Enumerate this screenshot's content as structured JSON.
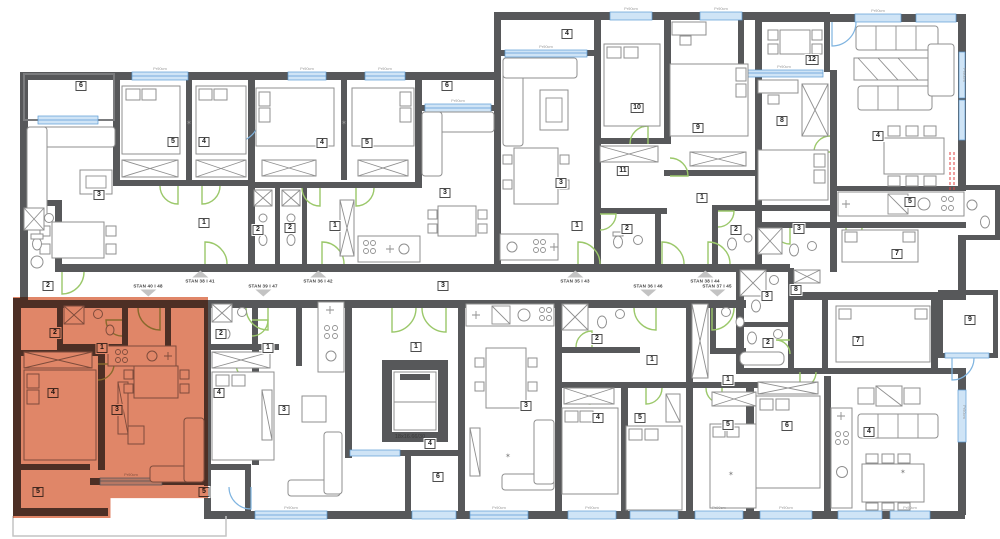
{
  "floorplan": {
    "stairs_note": "18x16.66/30",
    "window_label": "Pr90cm",
    "colors": {
      "wall": "#57585a",
      "door": "#9bc86a",
      "window_fill": "#cfe4f6",
      "window_line": "#5b9bd5",
      "furniture": "#8f8f8f",
      "arrow": "#c3c3c3",
      "red_dash": "#e04040",
      "highlight": "#e08668"
    },
    "highlight": {
      "left": 13,
      "top": 297,
      "width": 195,
      "height": 221
    },
    "corridor_labels": [
      {
        "text": "STAN 38 I 41",
        "x": 200,
        "y": 277,
        "dir": "up"
      },
      {
        "text": "STAN 36 I 42",
        "x": 318,
        "y": 277,
        "dir": "up"
      },
      {
        "text": "STAN 35 I 43",
        "x": 575,
        "y": 277,
        "dir": "up"
      },
      {
        "text": "STAN 38 I 44",
        "x": 705,
        "y": 277,
        "dir": "up"
      },
      {
        "text": "STAN 40 I 48",
        "x": 148,
        "y": 290,
        "dir": "down"
      },
      {
        "text": "STAN 39 I 47",
        "x": 263,
        "y": 290,
        "dir": "down"
      },
      {
        "text": "STAN 36 I 46",
        "x": 648,
        "y": 290,
        "dir": "down"
      },
      {
        "text": "STAN 37 I 45",
        "x": 717,
        "y": 290,
        "dir": "down"
      }
    ],
    "room_badges": [
      {
        "n": "6",
        "x": 81,
        "y": 86
      },
      {
        "n": "5",
        "x": 173,
        "y": 142
      },
      {
        "n": "4",
        "x": 204,
        "y": 142
      },
      {
        "n": "3",
        "x": 99,
        "y": 195
      },
      {
        "n": "1",
        "x": 204,
        "y": 223
      },
      {
        "n": "2",
        "x": 48,
        "y": 286
      },
      {
        "n": "4",
        "x": 322,
        "y": 143
      },
      {
        "n": "5",
        "x": 367,
        "y": 143
      },
      {
        "n": "6",
        "x": 447,
        "y": 86
      },
      {
        "n": "3",
        "x": 445,
        "y": 193
      },
      {
        "n": "1",
        "x": 335,
        "y": 226
      },
      {
        "n": "2",
        "x": 258,
        "y": 230
      },
      {
        "n": "2",
        "x": 290,
        "y": 228
      },
      {
        "n": "4",
        "x": 567,
        "y": 34
      },
      {
        "n": "10",
        "x": 637,
        "y": 108
      },
      {
        "n": "9",
        "x": 698,
        "y": 128
      },
      {
        "n": "11",
        "x": 623,
        "y": 171
      },
      {
        "n": "3",
        "x": 561,
        "y": 183
      },
      {
        "n": "1",
        "x": 577,
        "y": 226
      },
      {
        "n": "2",
        "x": 627,
        "y": 229
      },
      {
        "n": "1",
        "x": 702,
        "y": 198
      },
      {
        "n": "2",
        "x": 736,
        "y": 230
      },
      {
        "n": "12",
        "x": 812,
        "y": 60
      },
      {
        "n": "8",
        "x": 782,
        "y": 121
      },
      {
        "n": "4",
        "x": 878,
        "y": 136
      },
      {
        "n": "5",
        "x": 910,
        "y": 202
      },
      {
        "n": "3",
        "x": 799,
        "y": 229
      },
      {
        "n": "7",
        "x": 897,
        "y": 254
      },
      {
        "n": "3",
        "x": 443,
        "y": 286
      },
      {
        "n": "2",
        "x": 55,
        "y": 333
      },
      {
        "n": "1",
        "x": 102,
        "y": 348
      },
      {
        "n": "4",
        "x": 53,
        "y": 393
      },
      {
        "n": "3",
        "x": 117,
        "y": 410
      },
      {
        "n": "5",
        "x": 38,
        "y": 492
      },
      {
        "n": "2",
        "x": 221,
        "y": 334
      },
      {
        "n": "1",
        "x": 268,
        "y": 348
      },
      {
        "n": "4",
        "x": 219,
        "y": 393
      },
      {
        "n": "3",
        "x": 284,
        "y": 410
      },
      {
        "n": "5",
        "x": 204,
        "y": 492
      },
      {
        "n": "1",
        "x": 416,
        "y": 347
      },
      {
        "n": "4",
        "x": 430,
        "y": 444
      },
      {
        "n": "6",
        "x": 438,
        "y": 477
      },
      {
        "n": "2",
        "x": 597,
        "y": 339
      },
      {
        "n": "1",
        "x": 652,
        "y": 360
      },
      {
        "n": "3",
        "x": 526,
        "y": 406
      },
      {
        "n": "4",
        "x": 598,
        "y": 418
      },
      {
        "n": "5",
        "x": 640,
        "y": 418
      },
      {
        "n": "1",
        "x": 728,
        "y": 380
      },
      {
        "n": "5",
        "x": 728,
        "y": 425
      },
      {
        "n": "3",
        "x": 767,
        "y": 296
      },
      {
        "n": "8",
        "x": 796,
        "y": 290
      },
      {
        "n": "2",
        "x": 768,
        "y": 343
      },
      {
        "n": "7",
        "x": 858,
        "y": 341
      },
      {
        "n": "9",
        "x": 970,
        "y": 320
      },
      {
        "n": "6",
        "x": 787,
        "y": 426
      },
      {
        "n": "4",
        "x": 869,
        "y": 432
      }
    ]
  }
}
